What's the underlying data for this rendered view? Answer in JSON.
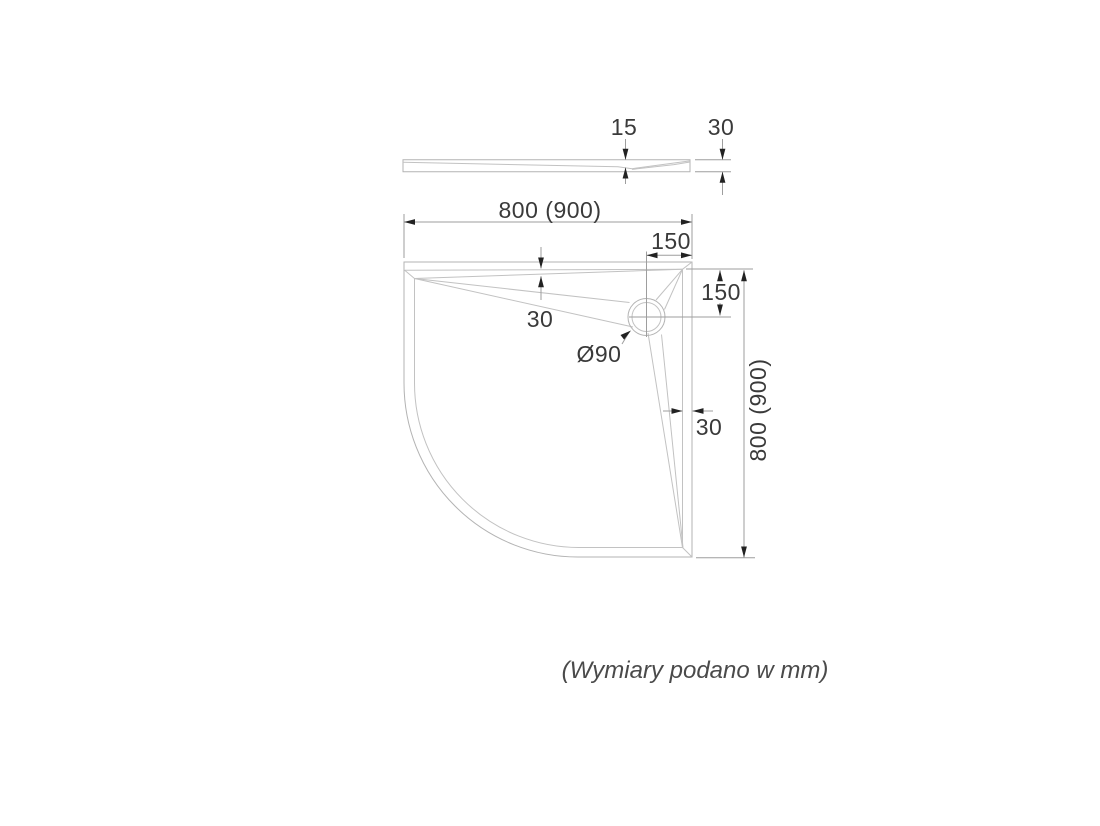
{
  "page": {
    "background": "#ffffff"
  },
  "drawing": {
    "units_note": "(Wymiary podano w mm)",
    "profile_view": {
      "edge_thickness": "15",
      "total_height": "30"
    },
    "plan_view": {
      "width": "800 (900)",
      "height": "800 (900)",
      "drain_offset_horizontal": "150",
      "drain_offset_vertical": "150",
      "rim_width_top": "30",
      "rim_width_right": "30",
      "drain_diameter": "Ø90"
    },
    "colors": {
      "geometry_line": "#b3b3b3",
      "dimension_line": "#9e9e9e",
      "arrowhead": "#222222",
      "text": "#3a3a3a"
    }
  }
}
